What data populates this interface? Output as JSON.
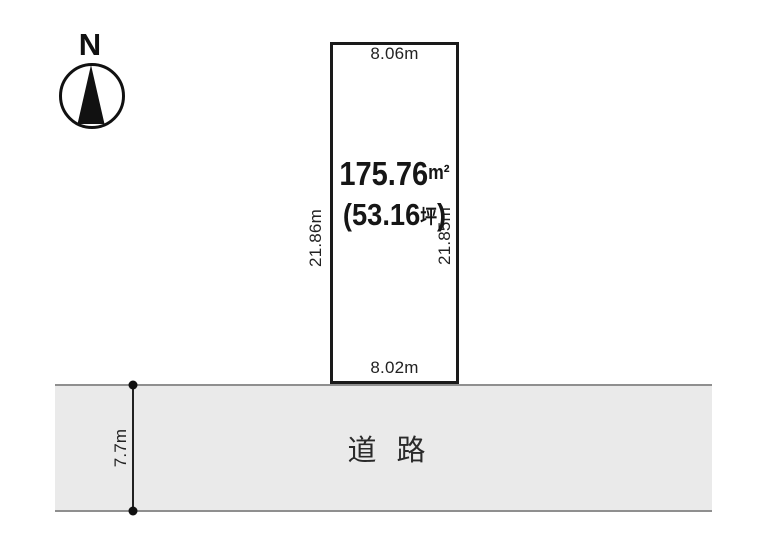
{
  "compass": {
    "north_label": "N"
  },
  "plot": {
    "top_width": "8.06m",
    "bottom_width": "8.02m",
    "left_depth": "21.86m",
    "right_depth": "21.85m",
    "area_sqm_value": "175.76",
    "area_sqm_unit": "m²",
    "area_tsubo_prefix": "(53.16",
    "area_tsubo_unit": "坪",
    "area_tsubo_suffix": ")"
  },
  "road": {
    "label": "道 路",
    "width_label": "7.7m"
  },
  "colors": {
    "plot_outline": "#1a1a1a",
    "road_fill": "#eaeaea",
    "road_border": "#8f8f8f",
    "text": "#1a1a1a"
  }
}
